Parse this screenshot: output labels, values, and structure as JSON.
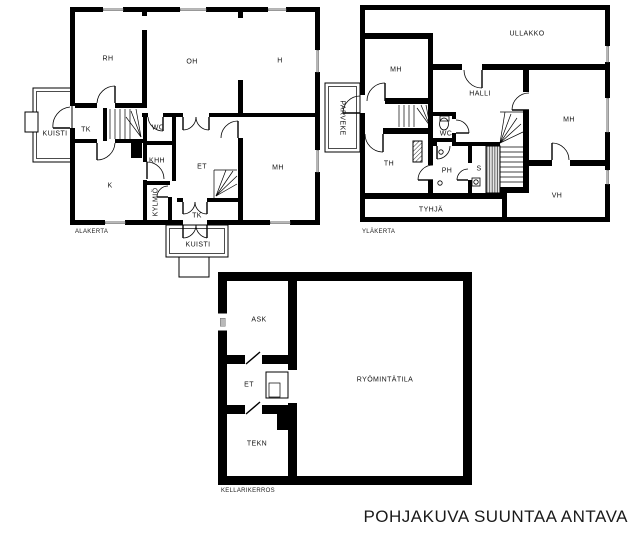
{
  "disclaimer": "POHJAKUVA SUUNTAA ANTAVA",
  "colors": {
    "wall": "#000000",
    "window_gray": "#b9b9b9",
    "background": "#ffffff",
    "text": "#1a1a1a"
  },
  "floors": {
    "alakerta": {
      "label": "ALAKERTA",
      "rooms": {
        "rh": "RH",
        "oh": "OH",
        "h": "H",
        "kuisti_left": "KUISTI",
        "tk_left": "TK",
        "wc": "WC",
        "khh": "KHH",
        "et": "ET",
        "mh": "MH",
        "k": "K",
        "kylmio": "KYLMIÖ",
        "tk_bottom": "TK",
        "kuisti_bottom": "KUISTI"
      }
    },
    "ylakerta": {
      "label": "YLÄKERTA",
      "rooms": {
        "ullakko": "ULLAKKO",
        "mh_left": "MH",
        "halli": "HALLI",
        "mh_right": "MH",
        "parveke": "PARVEKE",
        "wc": "WC",
        "th": "TH",
        "ph": "PH",
        "s": "S",
        "tyhja": "TYHJÄ",
        "vh": "VH"
      }
    },
    "kellari": {
      "label": "KELLARIKERROS",
      "rooms": {
        "ask": "ASK",
        "et": "ET",
        "tekn": "TEKN",
        "ryomintatila": "RYÖMINTÄTILA"
      }
    }
  }
}
